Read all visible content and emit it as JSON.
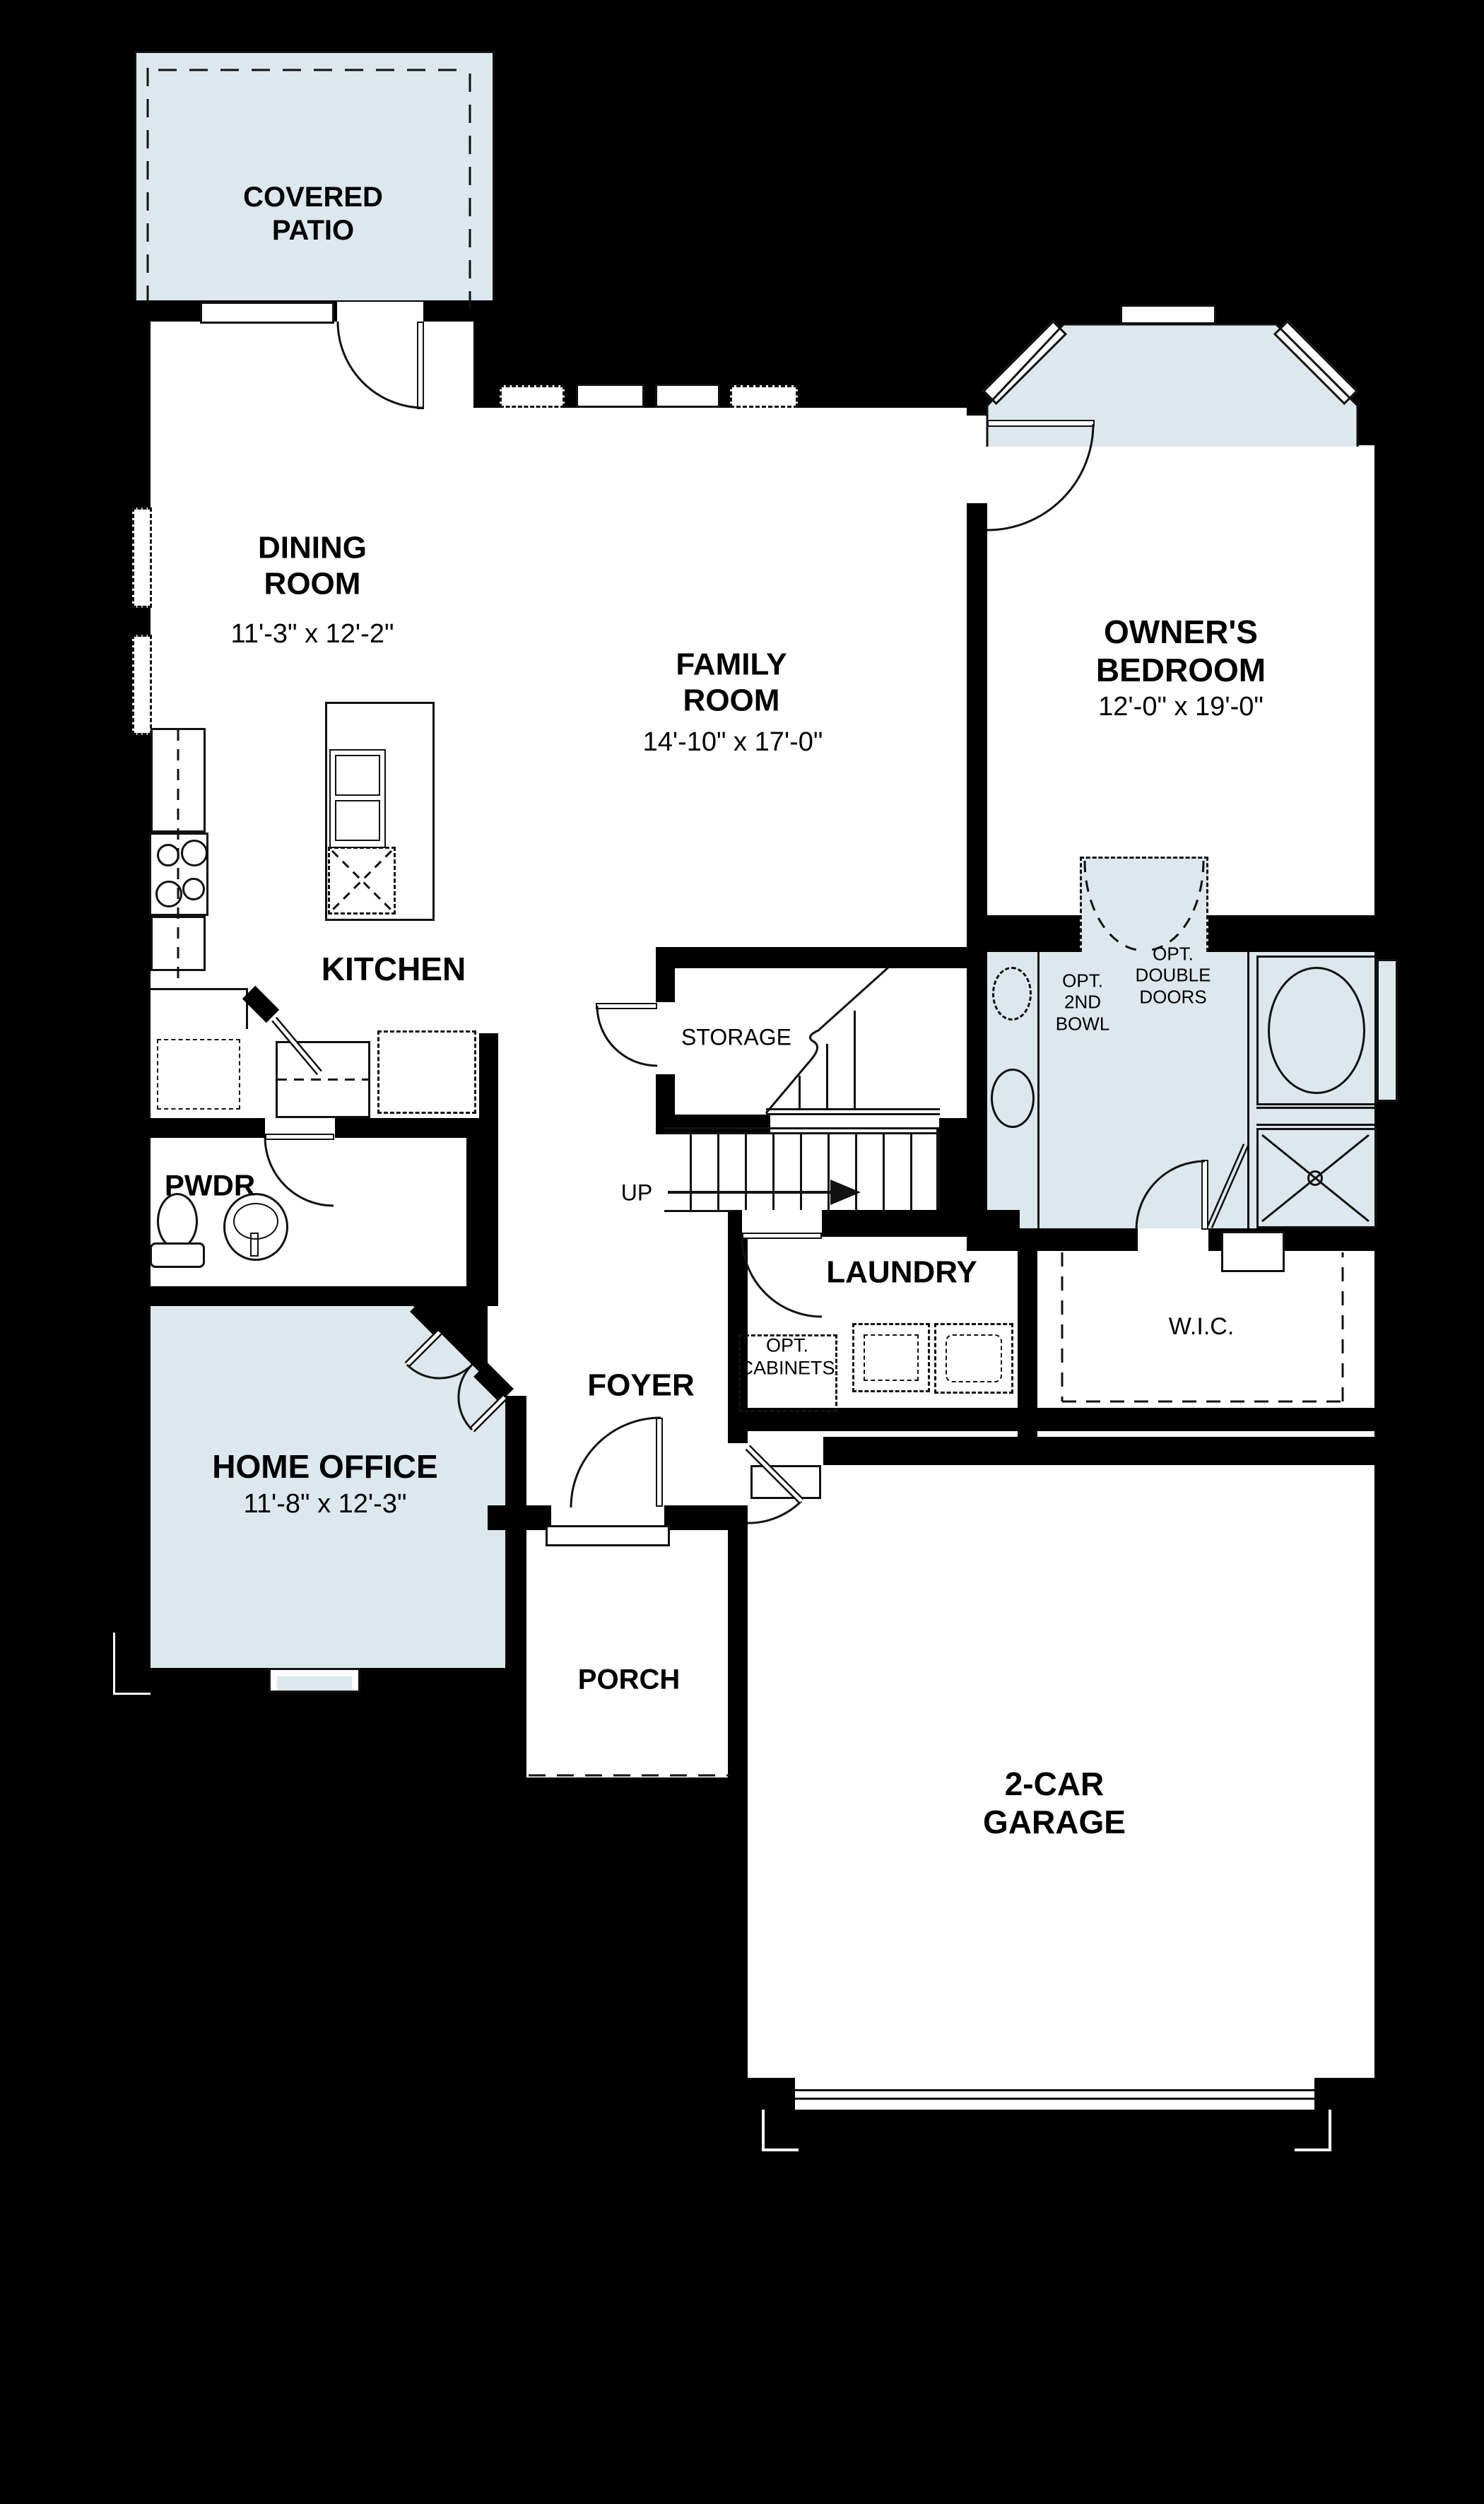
{
  "title": "First Floor Plan",
  "colors": {
    "background": "#000000",
    "floor": "#ffffff",
    "highlight_fill": "#dce8ed",
    "line": "#111111"
  },
  "rooms": {
    "covered_patio": {
      "label": "COVERED\nPATIO"
    },
    "dining_room": {
      "label": "DINING\nROOM",
      "dims": "11'-3\" x 12'-2\""
    },
    "family_room": {
      "label": "FAMILY\nROOM",
      "dims": "14'-10\" x 17'-0\""
    },
    "owners_bedroom": {
      "label": "OWNER'S\nBEDROOM",
      "dims": "12'-0\" x 19'-0\""
    },
    "kitchen": {
      "label": "KITCHEN"
    },
    "storage": {
      "label": "STORAGE"
    },
    "stairs": {
      "up_label": "UP"
    },
    "powder": {
      "label": "PWDR"
    },
    "laundry": {
      "label": "LAUNDRY",
      "opt_cabinets_label": "OPT.\nCABINETS"
    },
    "owners_bath": {
      "opt_2nd_bowl_label": "OPT.\n2ND\nBOWL",
      "opt_double_doors_label": "OPT.\nDOUBLE\nDOORS"
    },
    "wic": {
      "label": "W.I.C."
    },
    "foyer": {
      "label": "FOYER"
    },
    "home_office": {
      "label": "HOME OFFICE",
      "dims": "11'-8\" x 12'-3\""
    },
    "porch": {
      "label": "PORCH"
    },
    "garage": {
      "label": "2-CAR\nGARAGE"
    }
  }
}
